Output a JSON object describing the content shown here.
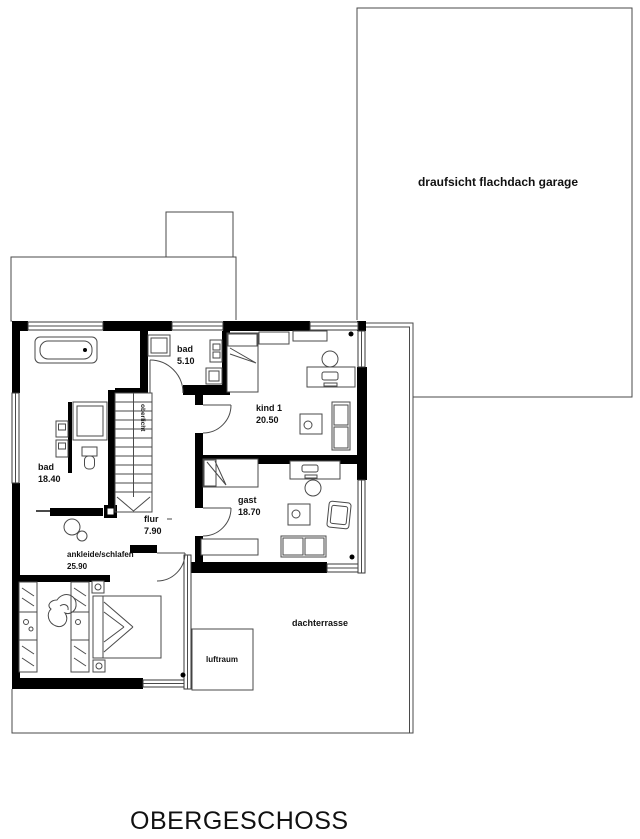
{
  "title": "OBERGESCHOSS",
  "garage": {
    "label": "draufsicht flachdach garage"
  },
  "rooms": {
    "bad_small": {
      "name": "bad",
      "area": "5.10"
    },
    "bad_large": {
      "name": "bad",
      "area": "18.40"
    },
    "kind1": {
      "name": "kind 1",
      "area": "20.50"
    },
    "gast": {
      "name": "gast",
      "area": "18.70"
    },
    "flur": {
      "name": "flur",
      "area": "7.90"
    },
    "schlafen": {
      "name": "ankleide/schlafen",
      "area": "25.90"
    },
    "terrasse": {
      "name": "dachterrasse"
    },
    "luftraum": {
      "name": "luftraum"
    }
  },
  "stairs": {
    "label": "oberlicht"
  },
  "colors": {
    "wall": "#000000",
    "thin_line": "#4a4a4a",
    "background": "#ffffff"
  }
}
